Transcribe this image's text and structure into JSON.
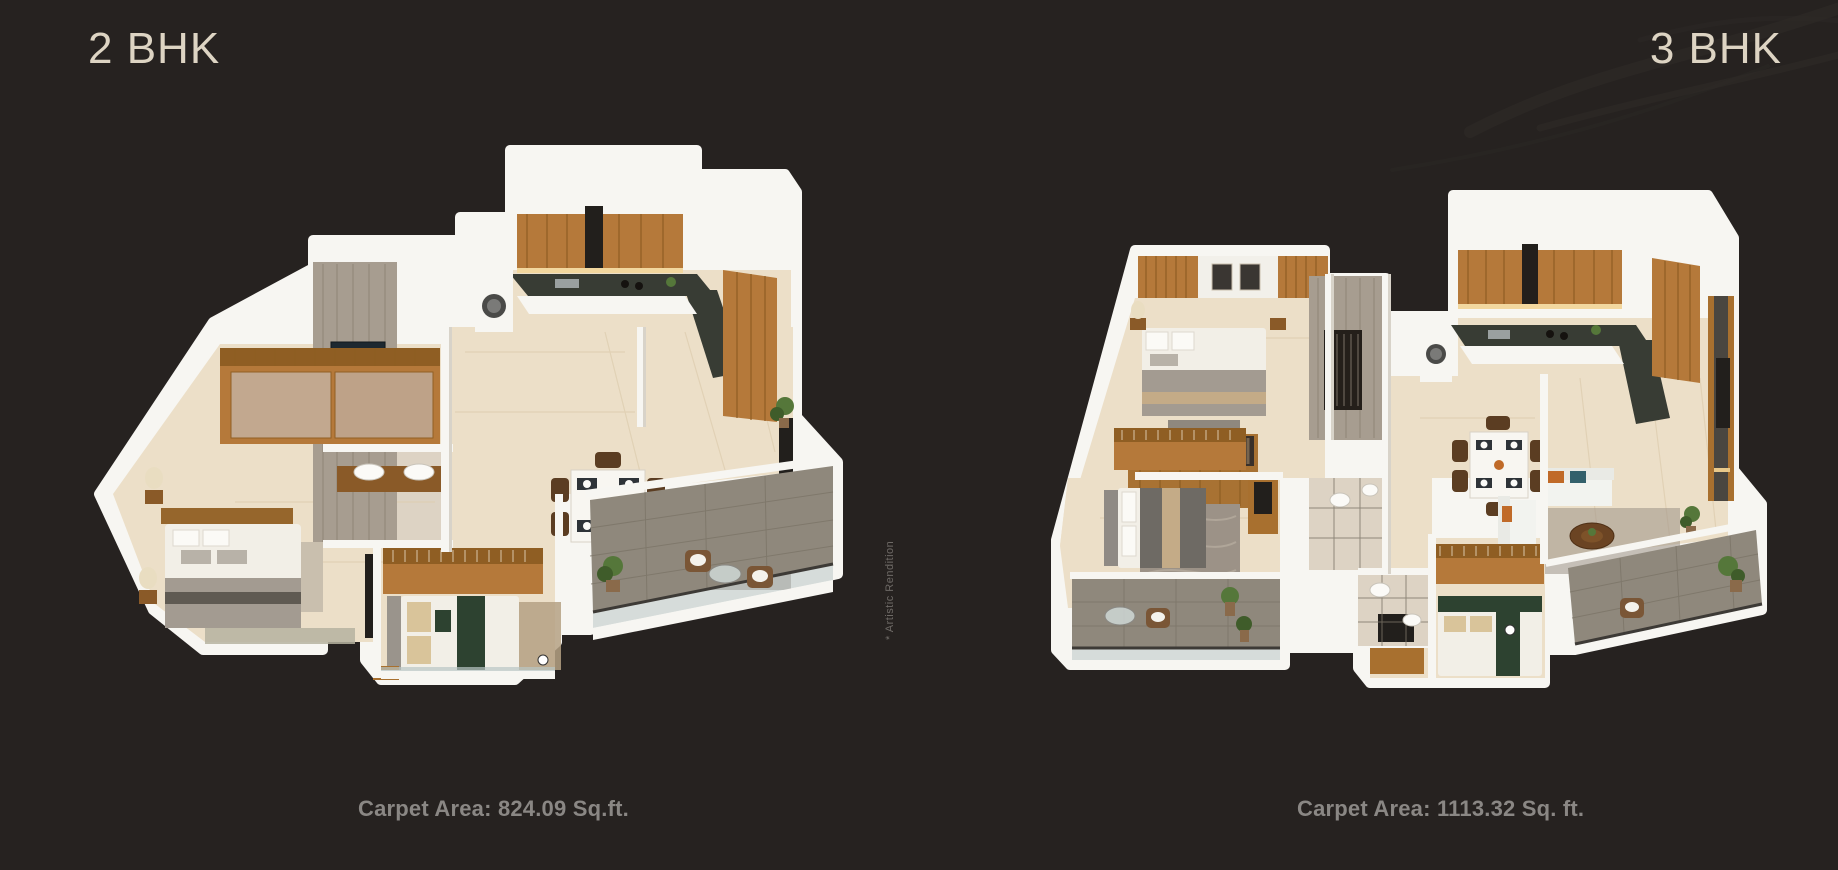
{
  "page": {
    "background": "#262220",
    "watermark": "* Artistic Rendition"
  },
  "palette": {
    "bg": "#262220",
    "title": "#ddd4c3",
    "caption": "#8a8784",
    "watermark": "#6e6a66"
  },
  "decor": {
    "swirl_color": "#2f2b28"
  },
  "style_colors": {
    "wall_white": "#f7f6f2",
    "floor_cream": "#ecdfc8",
    "wood": "#b5793a",
    "kitchen_counter_dark": "#383c34",
    "stone_wall_gray": "#a79d90",
    "balcony_tile_gray": "#8f887c",
    "cushion_orange": "#c06a28",
    "cushion_teal": "#33606b",
    "duvet_green": "#2d4230"
  },
  "plans": [
    {
      "id": "2bhk",
      "title": "2 BHK",
      "carpet_area": "Carpet Area: 824.09 Sq.ft."
    },
    {
      "id": "3bhk",
      "title": "3 BHK",
      "carpet_area": "Carpet Area: 1113.32 Sq. ft."
    }
  ]
}
